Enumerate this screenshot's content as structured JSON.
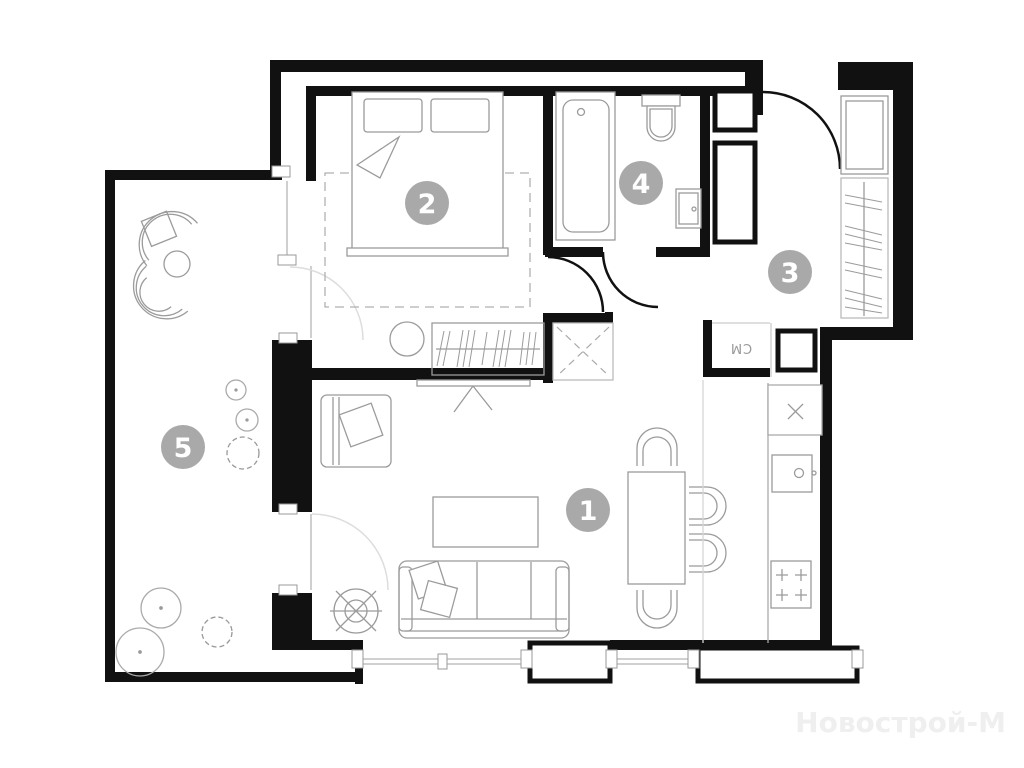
{
  "floorplan": {
    "watermark": "Новострой-М",
    "badges": [
      {
        "number": "1"
      },
      {
        "number": "2"
      },
      {
        "number": "3"
      },
      {
        "number": "4"
      },
      {
        "number": "5"
      }
    ],
    "labels": {
      "washing_machine": "СМ"
    },
    "colors": {
      "background": "#ffffff",
      "wall": "#111111",
      "furniture": "#9b9b9b",
      "furniture_light": "#c6c6c6",
      "badge": "#a9a9a9",
      "badge_text": "#ffffff",
      "watermark": "#efefef"
    }
  }
}
